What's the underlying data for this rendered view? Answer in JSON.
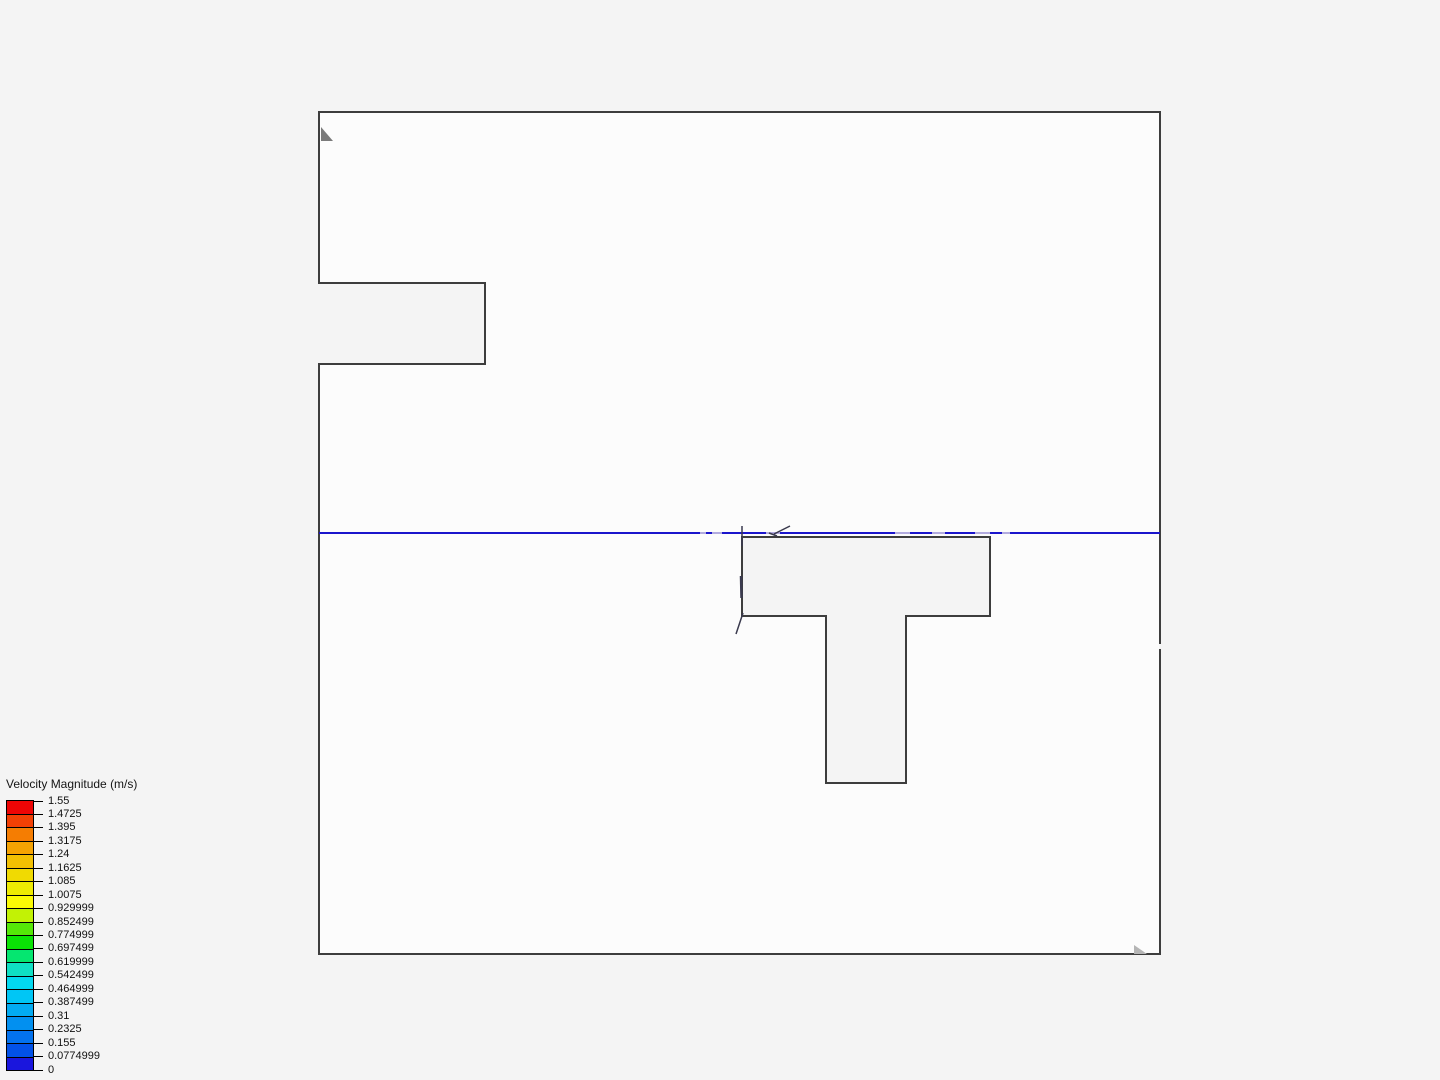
{
  "view": {
    "background_color": "#f4f4f4",
    "domain_fill": "#fcfcfc",
    "outline_color": "#3d3d3d",
    "contour_line_color": "#1b15cc",
    "contour_dash_color": "#b2abdf",
    "glyph_color": "#3a3a4e",
    "marker_top_left_color": "#7a7a7a",
    "marker_bottom_right_color": "#b5b5b5"
  },
  "legend": {
    "title": "Velocity Magnitude (m/s)",
    "range_min": 0,
    "range_max": 1.55,
    "ticks": [
      "1.55",
      "1.4725",
      "1.395",
      "1.3175",
      "1.24",
      "1.1625",
      "1.085",
      "1.0075",
      "0.929999",
      "0.852499",
      "0.774999",
      "0.697499",
      "0.619999",
      "0.542499",
      "0.464999",
      "0.387499",
      "0.31",
      "0.2325",
      "0.155",
      "0.0774999",
      "0"
    ],
    "colors": [
      "#ee0505",
      "#f24005",
      "#f57d02",
      "#f5a302",
      "#f2c002",
      "#f0da02",
      "#eeeb02",
      "#fbfb05",
      "#c2f205",
      "#55e808",
      "#0ae305",
      "#05e670",
      "#0fe0c4",
      "#02d8f0",
      "#00c6f5",
      "#02abf2",
      "#0290f0",
      "#0372ee",
      "#0252e8",
      "#1a16dd"
    ]
  }
}
